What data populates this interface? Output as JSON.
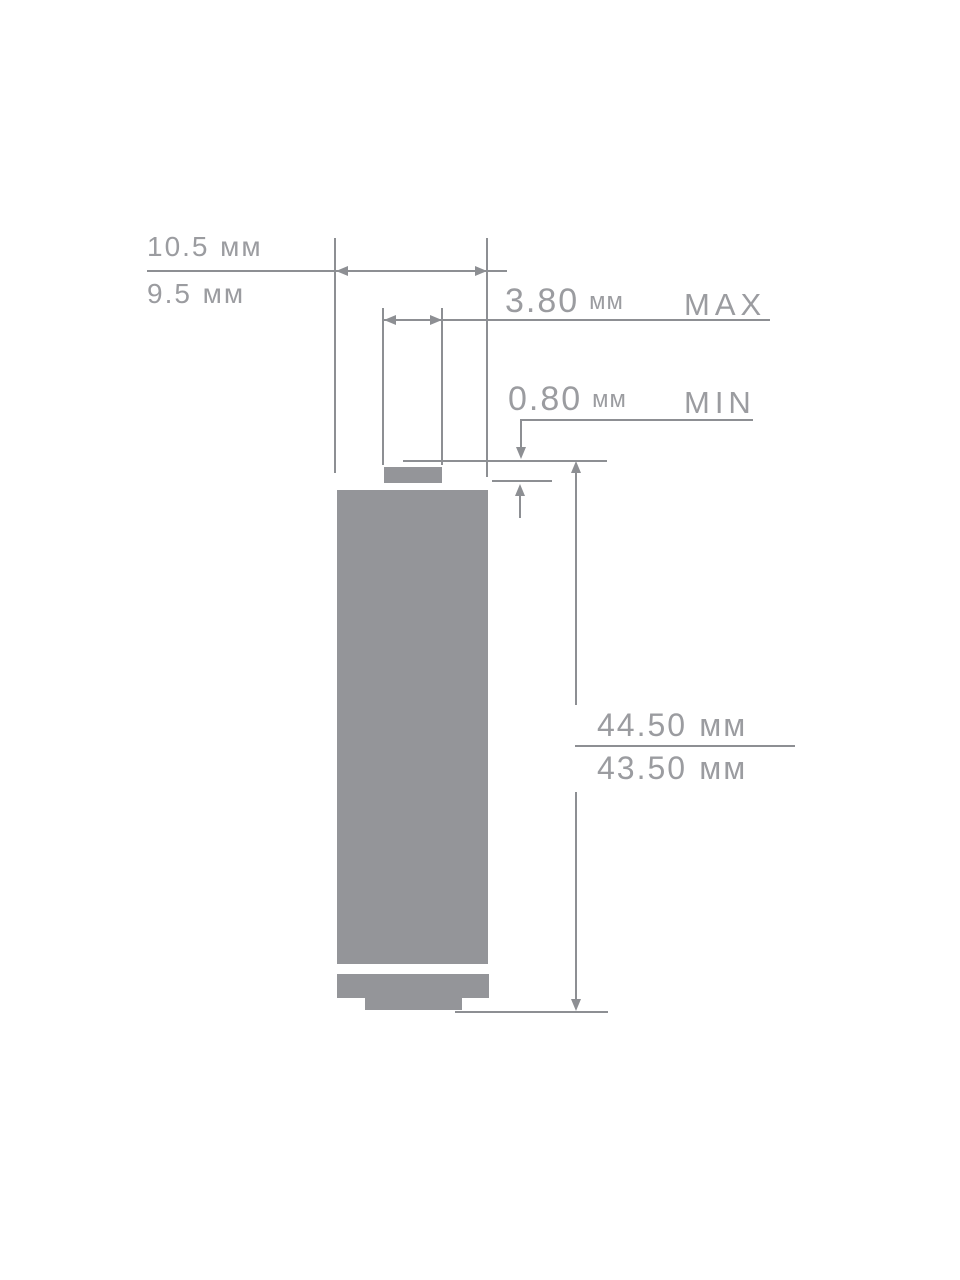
{
  "diagram": {
    "subject": "battery-size-drawing",
    "colors": {
      "background": "#ffffff",
      "line": "#8d8f93",
      "text": "#9b9ca0",
      "battery": "#949599"
    },
    "dimensions": {
      "body_diameter": {
        "max_value": "10.5",
        "min_value": "9.5",
        "unit": "мм"
      },
      "button_diameter": {
        "value": "3.80",
        "unit": "мм",
        "qualifier": "MAX"
      },
      "button_height": {
        "value": "0.80",
        "unit": "мм",
        "qualifier": "MIN"
      },
      "total_height": {
        "max_value": "44.50",
        "min_value": "43.50",
        "unit": "мм"
      }
    }
  }
}
